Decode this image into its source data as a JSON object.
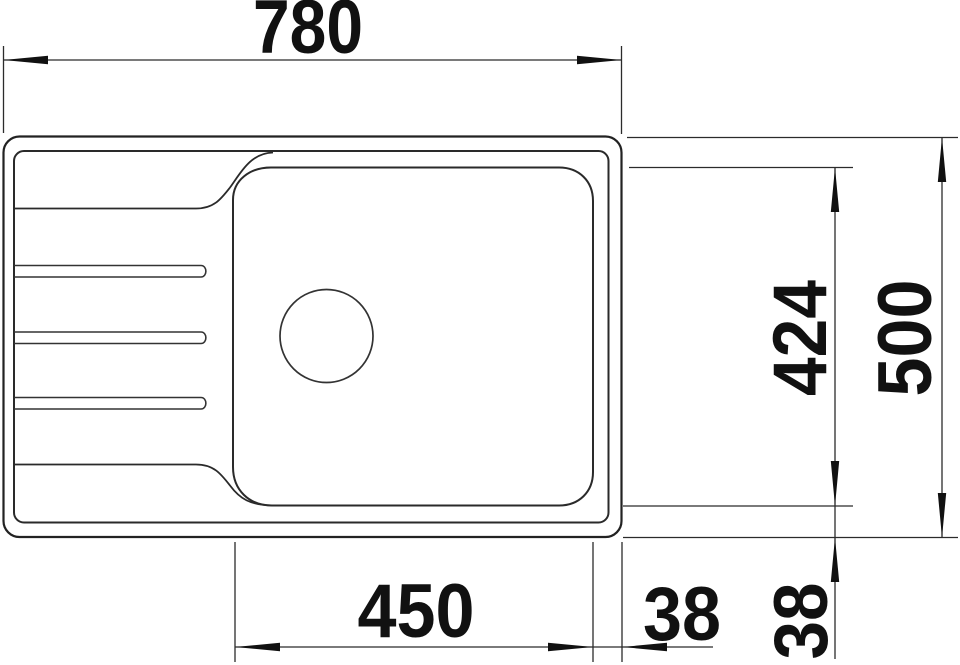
{
  "drawing": {
    "type": "technical-dimension-drawing",
    "subject": "kitchen sink with drainboard, top view",
    "units": "mm",
    "dimensions": {
      "overall_width": "780",
      "overall_depth": "500",
      "bowl_width": "450",
      "bowl_depth": "424",
      "bowl_to_edge_right": "38",
      "bowl_to_edge_bottom": "38"
    },
    "colors": {
      "line": "#222222",
      "text": "#111111",
      "background": "#ffffff"
    }
  }
}
